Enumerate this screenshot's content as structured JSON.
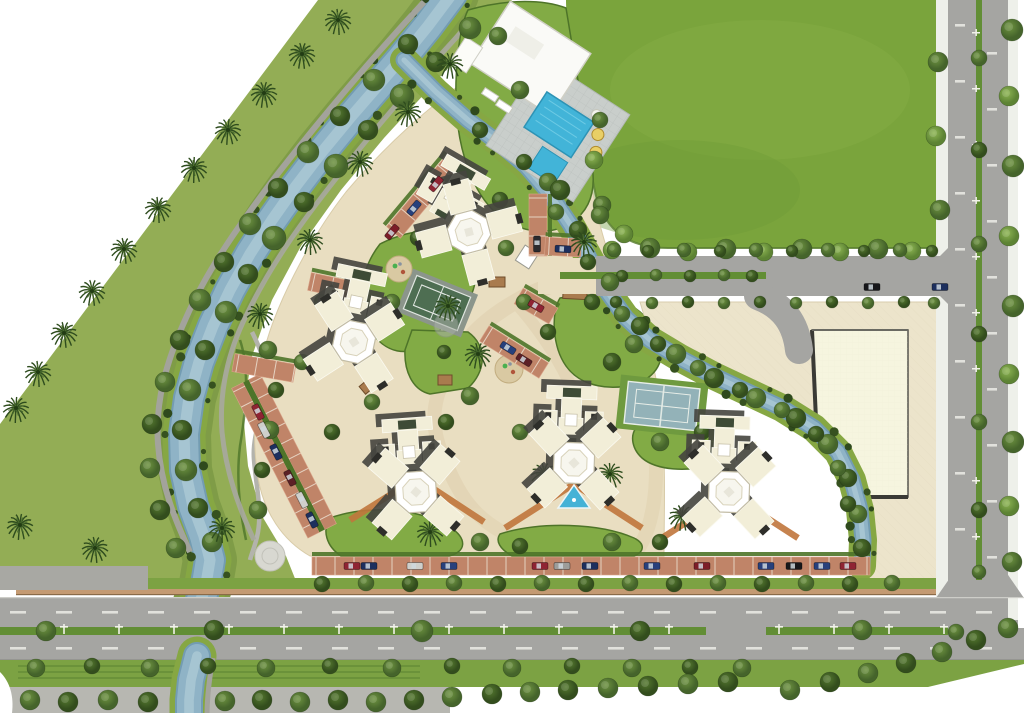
{
  "meta": {
    "description": "Aerial 3D master-plan rendering of a gated residential complex bordered by a tree-lined canal, a large lawn field, and two arterial roads",
    "width": 1024,
    "height": 713
  },
  "palette": {
    "bg": "#ffffff",
    "belt": "#93ad55",
    "beltDark": "#7f9c47",
    "field": "#7aa43c",
    "lawn": "#82ab45",
    "hedge": "#4e7429",
    "treeDark": "#36511f",
    "treeMid": "#4d7131",
    "treeLight": "#6d9a3f",
    "palm": "#2c4a1e",
    "canal": "#8fb3c6",
    "canalDeep": "#739cb2",
    "canalLight": "#aac8d4",
    "bank": "#86a743",
    "road": "#a5a5a2",
    "sidewalk": "#eef0ea",
    "median": "#628e35",
    "wall": "#c49a72",
    "pavingCream": "#e9dec1",
    "pathTan": "#dbc9a4",
    "plaza": "#ece4cb",
    "brick": "#c08468",
    "brickLight": "#d9a388",
    "stallLine": "#efe6d8",
    "bldgCream": "#f2eed8",
    "bldgWhite": "#ffffff",
    "bldgShadow": "#45453f",
    "roofDark": "#3e4b36",
    "notch": "#2e2e2a",
    "pool": "#42b4d8",
    "deck": "#c9cecb",
    "courtTeal": "#93b2b8",
    "courtGreen": "#4e6e52",
    "chevron": "#c0763c",
    "pergola": "#a97b4e"
  },
  "canals": {
    "a": {
      "width": 28,
      "points": [
        [
          452,
          -6
        ],
        [
          428,
          26
        ],
        [
          402,
          58
        ],
        [
          376,
          88
        ],
        [
          350,
          118
        ],
        [
          322,
          152
        ],
        [
          296,
          186
        ],
        [
          272,
          220
        ],
        [
          250,
          254
        ],
        [
          230,
          290
        ],
        [
          213,
          326
        ],
        [
          199,
          362
        ],
        [
          189,
          398
        ],
        [
          184,
          434
        ],
        [
          185,
          470
        ],
        [
          193,
          506
        ],
        [
          204,
          536
        ],
        [
          210,
          560
        ],
        [
          206,
          584
        ],
        [
          199,
          606
        ]
      ]
    },
    "a_south": {
      "width": 24,
      "points": [
        [
          197,
          656
        ],
        [
          191,
          680
        ],
        [
          189,
          700
        ],
        [
          189,
          716
        ]
      ]
    },
    "b": {
      "width": 13,
      "points": [
        [
          404,
          60
        ],
        [
          436,
          92
        ],
        [
          468,
          120
        ],
        [
          500,
          144
        ],
        [
          526,
          166
        ],
        [
          550,
          194
        ],
        [
          570,
          224
        ],
        [
          588,
          256
        ],
        [
          606,
          290
        ],
        [
          626,
          318
        ],
        [
          650,
          340
        ],
        [
          680,
          358
        ],
        [
          714,
          376
        ],
        [
          748,
          392
        ],
        [
          782,
          408
        ],
        [
          814,
          428
        ],
        [
          838,
          452
        ],
        [
          852,
          480
        ],
        [
          860,
          510
        ],
        [
          863,
          540
        ],
        [
          862,
          566
        ]
      ]
    }
  },
  "towers": [
    {
      "x": 452,
      "y": 196,
      "rot": 30,
      "core": false
    },
    {
      "x": 469,
      "y": 232,
      "rot": 30,
      "core": true
    },
    {
      "x": 356,
      "y": 302,
      "rot": 12,
      "core": false
    },
    {
      "x": 354,
      "y": 342,
      "rot": 12,
      "core": true
    },
    {
      "x": 409,
      "y": 452,
      "rot": -4,
      "core": false
    },
    {
      "x": 416,
      "y": 492,
      "rot": -4,
      "core": true
    },
    {
      "x": 571,
      "y": 420,
      "rot": 2,
      "core": false
    },
    {
      "x": 574,
      "y": 463,
      "rot": 2,
      "core": true
    },
    {
      "x": 724,
      "y": 450,
      "rot": 2,
      "core": false
    },
    {
      "x": 729,
      "y": 492,
      "rot": 2,
      "core": true
    }
  ],
  "parking_strips": [
    {
      "x": 284,
      "y": 456,
      "rot": 63,
      "len": 168,
      "rows": 2
    },
    {
      "x": 424,
      "y": 196,
      "rot": -50,
      "len": 95,
      "rows": 1
    },
    {
      "x": 331,
      "y": 286,
      "rot": 12,
      "len": 44,
      "rows": 1
    },
    {
      "x": 264,
      "y": 368,
      "rot": 10,
      "len": 62,
      "rows": 1
    },
    {
      "x": 538,
      "y": 225,
      "rot": 90,
      "len": 62,
      "rows": 1
    },
    {
      "x": 563,
      "y": 247,
      "rot": 3,
      "len": 36,
      "rows": 1
    },
    {
      "x": 536,
      "y": 306,
      "rot": 30,
      "len": 40,
      "rows": 1
    },
    {
      "x": 514,
      "y": 352,
      "rot": 32,
      "len": 70,
      "rows": 1
    },
    {
      "x": 591,
      "y": 566,
      "rot": 0,
      "len": 558,
      "rows": 1
    }
  ],
  "cars": [
    [
      352,
      566,
      0,
      "#8f2433"
    ],
    [
      369,
      566,
      0,
      "#1d2f5e"
    ],
    [
      415,
      566,
      0,
      "#cfcfcb"
    ],
    [
      449,
      566,
      0,
      "#27407c"
    ],
    [
      540,
      566,
      0,
      "#8f2433"
    ],
    [
      562,
      566,
      0,
      "#9d9d9a"
    ],
    [
      590,
      566,
      0,
      "#1d2f5e"
    ],
    [
      652,
      566,
      0,
      "#27407c"
    ],
    [
      702,
      566,
      0,
      "#7c1d28"
    ],
    [
      766,
      566,
      0,
      "#27407c"
    ],
    [
      794,
      566,
      0,
      "#17171a"
    ],
    [
      822,
      566,
      0,
      "#27407c"
    ],
    [
      848,
      566,
      0,
      "#8f2433"
    ],
    [
      258,
      412,
      63,
      "#8f2433"
    ],
    [
      264,
      430,
      63,
      "#cfcfcb"
    ],
    [
      276,
      452,
      63,
      "#1d2f5e"
    ],
    [
      290,
      478,
      63,
      "#5c2026"
    ],
    [
      302,
      500,
      63,
      "#cfcfcb"
    ],
    [
      312,
      520,
      63,
      "#1d2f5e"
    ],
    [
      436,
      184,
      -50,
      "#8f2433"
    ],
    [
      414,
      208,
      -50,
      "#27407c"
    ],
    [
      392,
      232,
      -50,
      "#7c1d28"
    ],
    [
      563,
      249,
      3,
      "#1d2f5e"
    ],
    [
      537,
      244,
      90,
      "#2a2a2e"
    ],
    [
      536,
      306,
      30,
      "#8f2433"
    ],
    [
      508,
      348,
      32,
      "#27407c"
    ],
    [
      524,
      360,
      32,
      "#5c2026"
    ],
    [
      940,
      287,
      0,
      "#1d2f5e"
    ],
    [
      872,
      287,
      0,
      "#17171a"
    ]
  ],
  "pergolas": [
    [
      575,
      293,
      24,
      12,
      3
    ],
    [
      370,
      384,
      20,
      10,
      -40
    ],
    [
      583,
      417,
      14,
      11,
      0
    ],
    [
      497,
      282,
      16,
      10,
      0
    ],
    [
      445,
      380,
      14,
      10,
      0
    ]
  ],
  "palms": [
    [
      338,
      20
    ],
    [
      302,
      54
    ],
    [
      264,
      93
    ],
    [
      228,
      130
    ],
    [
      194,
      168
    ],
    [
      158,
      208
    ],
    [
      124,
      249
    ],
    [
      92,
      291
    ],
    [
      64,
      333
    ],
    [
      38,
      372
    ],
    [
      16,
      408
    ],
    [
      20,
      525
    ],
    [
      95,
      548
    ],
    [
      222,
      528
    ],
    [
      260,
      314
    ],
    [
      310,
      240
    ],
    [
      360,
      162
    ],
    [
      408,
      112
    ],
    [
      450,
      64
    ],
    [
      448,
      306
    ],
    [
      478,
      354
    ],
    [
      430,
      532
    ],
    [
      544,
      474
    ],
    [
      610,
      474
    ],
    [
      682,
      516
    ],
    [
      584,
      242
    ]
  ],
  "trees": [
    [
      470,
      28,
      11,
      1
    ],
    [
      436,
      62,
      10,
      0
    ],
    [
      402,
      96,
      12,
      1
    ],
    [
      368,
      130,
      10,
      0
    ],
    [
      336,
      166,
      12,
      1
    ],
    [
      304,
      202,
      10,
      0
    ],
    [
      274,
      238,
      12,
      1
    ],
    [
      248,
      274,
      10,
      0
    ],
    [
      226,
      312,
      11,
      1
    ],
    [
      205,
      350,
      10,
      0
    ],
    [
      190,
      390,
      11,
      1
    ],
    [
      182,
      430,
      10,
      0
    ],
    [
      186,
      470,
      11,
      1
    ],
    [
      198,
      508,
      10,
      0
    ],
    [
      212,
      542,
      10,
      1
    ],
    [
      498,
      36,
      9,
      1
    ],
    [
      408,
      44,
      10,
      0
    ],
    [
      374,
      80,
      11,
      1
    ],
    [
      340,
      116,
      10,
      0
    ],
    [
      308,
      152,
      11,
      1
    ],
    [
      278,
      188,
      10,
      0
    ],
    [
      250,
      224,
      11,
      1
    ],
    [
      224,
      262,
      10,
      0
    ],
    [
      200,
      300,
      11,
      1
    ],
    [
      180,
      340,
      10,
      0
    ],
    [
      165,
      382,
      10,
      1
    ],
    [
      152,
      424,
      10,
      0
    ],
    [
      150,
      468,
      10,
      1
    ],
    [
      160,
      510,
      10,
      0
    ],
    [
      176,
      548,
      10,
      1
    ],
    [
      612,
      250,
      9,
      2
    ],
    [
      650,
      248,
      10,
      1
    ],
    [
      688,
      252,
      9,
      2
    ],
    [
      726,
      249,
      10,
      1
    ],
    [
      764,
      252,
      9,
      2
    ],
    [
      802,
      249,
      10,
      1
    ],
    [
      840,
      252,
      9,
      2
    ],
    [
      878,
      249,
      10,
      1
    ],
    [
      912,
      251,
      9,
      2
    ],
    [
      600,
      120,
      8,
      1
    ],
    [
      594,
      160,
      9,
      2
    ],
    [
      602,
      205,
      9,
      1
    ],
    [
      624,
      234,
      9,
      2
    ],
    [
      938,
      62,
      10,
      1
    ],
    [
      936,
      136,
      10,
      2
    ],
    [
      940,
      210,
      10,
      1
    ],
    [
      979,
      58,
      8,
      1
    ],
    [
      979,
      150,
      8,
      0
    ],
    [
      979,
      244,
      8,
      1
    ],
    [
      979,
      334,
      8,
      0
    ],
    [
      979,
      422,
      8,
      1
    ],
    [
      979,
      510,
      8,
      0
    ],
    [
      979,
      572,
      7,
      1
    ],
    [
      1012,
      30,
      11,
      1
    ],
    [
      1009,
      96,
      10,
      2
    ],
    [
      1013,
      166,
      11,
      1
    ],
    [
      1009,
      236,
      10,
      2
    ],
    [
      1013,
      306,
      11,
      1
    ],
    [
      1009,
      374,
      10,
      2
    ],
    [
      1013,
      442,
      11,
      1
    ],
    [
      1009,
      506,
      10,
      2
    ],
    [
      1012,
      562,
      10,
      1
    ],
    [
      46,
      631,
      10,
      1
    ],
    [
      214,
      630,
      10,
      0
    ],
    [
      422,
      631,
      11,
      1
    ],
    [
      640,
      631,
      10,
      0
    ],
    [
      862,
      630,
      10,
      1
    ],
    [
      956,
      632,
      8,
      1
    ],
    [
      36,
      668,
      9,
      1
    ],
    [
      92,
      666,
      8,
      0
    ],
    [
      150,
      668,
      9,
      1
    ],
    [
      208,
      666,
      8,
      0
    ],
    [
      266,
      668,
      9,
      1
    ],
    [
      330,
      666,
      8,
      0
    ],
    [
      392,
      668,
      9,
      1
    ],
    [
      452,
      666,
      8,
      0
    ],
    [
      512,
      668,
      9,
      1
    ],
    [
      572,
      666,
      8,
      0
    ],
    [
      632,
      668,
      9,
      1
    ],
    [
      690,
      667,
      8,
      0
    ],
    [
      742,
      668,
      9,
      1
    ],
    [
      30,
      700,
      10,
      1
    ],
    [
      68,
      702,
      10,
      0
    ],
    [
      108,
      700,
      10,
      1
    ],
    [
      148,
      702,
      10,
      0
    ],
    [
      225,
      701,
      10,
      1
    ],
    [
      262,
      700,
      10,
      0
    ],
    [
      300,
      702,
      10,
      1
    ],
    [
      338,
      700,
      10,
      0
    ],
    [
      376,
      702,
      10,
      1
    ],
    [
      414,
      700,
      10,
      0
    ],
    [
      452,
      697,
      10,
      1
    ],
    [
      492,
      694,
      10,
      0
    ],
    [
      530,
      692,
      10,
      1
    ],
    [
      568,
      690,
      10,
      0
    ],
    [
      608,
      688,
      10,
      1
    ],
    [
      648,
      686,
      10,
      0
    ],
    [
      688,
      684,
      10,
      1
    ],
    [
      728,
      682,
      10,
      0
    ],
    [
      790,
      690,
      10,
      1
    ],
    [
      830,
      682,
      10,
      0
    ],
    [
      868,
      673,
      10,
      1
    ],
    [
      906,
      663,
      10,
      0
    ],
    [
      942,
      652,
      10,
      1
    ],
    [
      976,
      640,
      10,
      0
    ],
    [
      1008,
      628,
      10,
      1
    ],
    [
      322,
      584,
      8,
      0
    ],
    [
      366,
      583,
      8,
      1
    ],
    [
      410,
      584,
      8,
      0
    ],
    [
      454,
      583,
      8,
      1
    ],
    [
      498,
      584,
      8,
      0
    ],
    [
      542,
      583,
      8,
      1
    ],
    [
      586,
      584,
      8,
      0
    ],
    [
      630,
      583,
      8,
      1
    ],
    [
      674,
      584,
      8,
      0
    ],
    [
      718,
      583,
      8,
      1
    ],
    [
      762,
      584,
      8,
      0
    ],
    [
      806,
      583,
      8,
      1
    ],
    [
      850,
      584,
      8,
      0
    ],
    [
      892,
      583,
      8,
      1
    ],
    [
      622,
      276,
      6,
      0
    ],
    [
      656,
      275,
      6,
      1
    ],
    [
      690,
      276,
      6,
      0
    ],
    [
      724,
      275,
      6,
      1
    ],
    [
      752,
      276,
      6,
      0
    ],
    [
      614,
      250,
      7,
      1
    ],
    [
      648,
      251,
      6,
      0
    ],
    [
      684,
      250,
      7,
      1
    ],
    [
      720,
      251,
      6,
      0
    ],
    [
      756,
      250,
      7,
      1
    ],
    [
      792,
      251,
      6,
      0
    ],
    [
      828,
      250,
      7,
      1
    ],
    [
      864,
      251,
      6,
      0
    ],
    [
      900,
      250,
      7,
      1
    ],
    [
      932,
      251,
      6,
      0
    ],
    [
      616,
      302,
      6,
      0
    ],
    [
      652,
      303,
      6,
      1
    ],
    [
      688,
      302,
      6,
      0
    ],
    [
      724,
      303,
      6,
      1
    ],
    [
      760,
      302,
      6,
      0
    ],
    [
      796,
      303,
      6,
      1
    ],
    [
      832,
      302,
      6,
      0
    ],
    [
      868,
      303,
      6,
      1
    ],
    [
      904,
      302,
      6,
      0
    ],
    [
      934,
      303,
      6,
      1
    ],
    [
      548,
      182,
      9,
      1
    ],
    [
      578,
      230,
      9,
      0
    ],
    [
      610,
      282,
      9,
      1
    ],
    [
      640,
      326,
      9,
      0
    ],
    [
      676,
      354,
      10,
      1
    ],
    [
      714,
      378,
      10,
      0
    ],
    [
      756,
      398,
      10,
      1
    ],
    [
      796,
      418,
      10,
      0
    ],
    [
      828,
      444,
      10,
      1
    ],
    [
      848,
      478,
      9,
      0
    ],
    [
      858,
      514,
      9,
      1
    ],
    [
      862,
      548,
      9,
      0
    ],
    [
      524,
      162,
      8,
      0
    ],
    [
      556,
      212,
      8,
      1
    ],
    [
      588,
      262,
      8,
      0
    ],
    [
      622,
      314,
      8,
      1
    ],
    [
      658,
      344,
      8,
      0
    ],
    [
      698,
      368,
      8,
      1
    ],
    [
      740,
      390,
      8,
      0
    ],
    [
      782,
      410,
      8,
      1
    ],
    [
      816,
      434,
      8,
      0
    ],
    [
      838,
      468,
      8,
      1
    ],
    [
      848,
      504,
      8,
      0
    ],
    [
      470,
      216,
      9,
      1
    ],
    [
      500,
      200,
      8,
      0
    ],
    [
      524,
      302,
      8,
      1
    ],
    [
      548,
      332,
      8,
      0
    ],
    [
      470,
      396,
      9,
      1
    ],
    [
      446,
      422,
      8,
      0
    ],
    [
      520,
      432,
      8,
      1
    ],
    [
      612,
      362,
      9,
      0
    ],
    [
      634,
      344,
      9,
      1
    ],
    [
      592,
      302,
      8,
      0
    ],
    [
      660,
      442,
      9,
      1
    ],
    [
      702,
      432,
      8,
      0
    ],
    [
      480,
      542,
      9,
      1
    ],
    [
      520,
      546,
      8,
      0
    ],
    [
      612,
      542,
      9,
      1
    ],
    [
      660,
      542,
      8,
      0
    ],
    [
      372,
      402,
      8,
      1
    ],
    [
      332,
      432,
      8,
      0
    ],
    [
      302,
      362,
      8,
      1
    ],
    [
      322,
      302,
      8,
      0
    ],
    [
      392,
      302,
      8,
      1
    ],
    [
      418,
      238,
      8,
      0
    ],
    [
      506,
      248,
      8,
      1
    ],
    [
      444,
      352,
      7,
      0
    ],
    [
      398,
      425,
      7,
      1
    ],
    [
      268,
      350,
      9,
      1
    ],
    [
      276,
      390,
      8,
      0
    ],
    [
      270,
      430,
      9,
      1
    ],
    [
      262,
      470,
      8,
      0
    ],
    [
      258,
      510,
      9,
      1
    ],
    [
      520,
      90,
      9,
      1
    ],
    [
      560,
      190,
      10,
      0
    ],
    [
      600,
      215,
      9,
      1
    ],
    [
      480,
      130,
      8,
      0
    ]
  ],
  "amenities": {
    "pool": {
      "x": 546,
      "y": 108,
      "rot": 33
    },
    "courts": [
      {
        "x": 437,
        "y": 303,
        "rot": 22,
        "style": "green"
      },
      {
        "x": 662,
        "y": 406,
        "rot": 6,
        "style": "blue"
      }
    ],
    "playgrounds": [
      [
        399,
        269,
        13
      ],
      [
        509,
        369,
        14
      ]
    ],
    "water_feature": {
      "x": 574,
      "y": 500
    },
    "paved_circle": [
      270,
      556,
      15
    ],
    "gate": {
      "x": 527,
      "y": 257,
      "rot": 33
    }
  }
}
